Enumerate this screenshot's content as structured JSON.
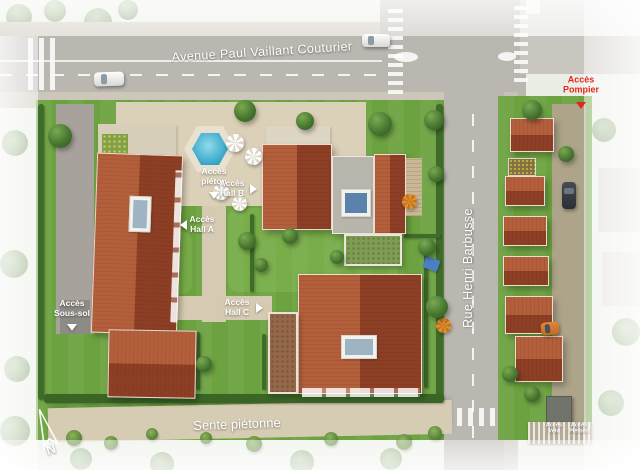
{
  "labels": {
    "avenue": "Avenue Paul Vaillant Couturier",
    "rue": "Rue Henri Barbusse",
    "sente": "Sente piétonne",
    "acces_pompier": "Accès Pompier",
    "acces_pieton": "Accès piéton",
    "acces_hall_a": "Accès Hall A",
    "acces_hall_b": "Accès Hall B",
    "acces_hall_c": "Accès Hall C",
    "acces_sous_sol": "Accès Sous-sol",
    "acces_velo": "Accès Vélo",
    "acces_pietons": "Accès Piétons"
  },
  "compass": {
    "north": "N"
  },
  "colors": {
    "roof_terracotta": "#9e4a2d",
    "lawn_green": "#6ca23f",
    "road_grey": "#bab7b1",
    "plaza_beige": "#dbd0b8",
    "pool_blue": "#55c0dc",
    "alert_red": "#e5251c",
    "label_white": "#ffffff"
  }
}
